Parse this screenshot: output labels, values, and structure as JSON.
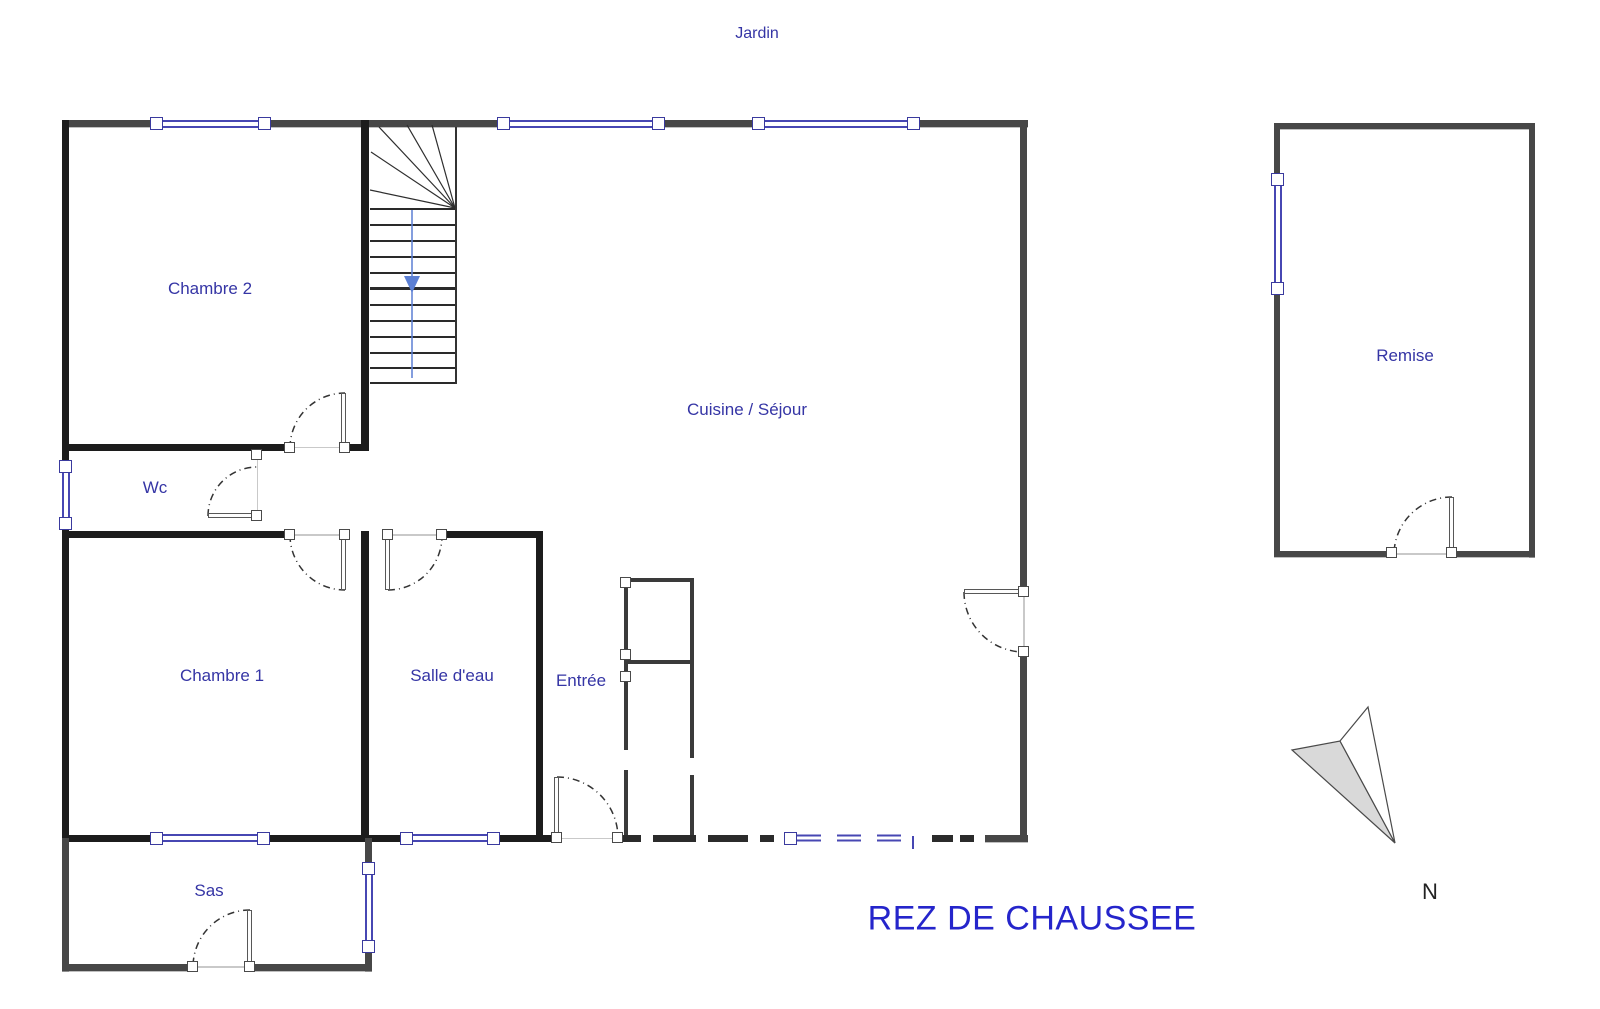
{
  "plan": {
    "title": "REZ DE CHAUSSEE",
    "garden_label": "Jardin",
    "north_label": "N",
    "rooms": [
      {
        "id": "chambre2",
        "label": "Chambre 2"
      },
      {
        "id": "wc",
        "label": "Wc"
      },
      {
        "id": "chambre1",
        "label": "Chambre 1"
      },
      {
        "id": "salle-deau",
        "label": "Salle d'eau"
      },
      {
        "id": "entree",
        "label": "Entrée"
      },
      {
        "id": "cuisine-sejour",
        "label": "Cuisine / Séjour"
      },
      {
        "id": "sas",
        "label": "Sas"
      },
      {
        "id": "remise",
        "label": "Remise"
      }
    ]
  },
  "colors": {
    "label_blue": "#3535a5",
    "title_blue": "#2525cb",
    "window_blue": "#4747b3",
    "wall_black": "#1c1c1c",
    "wall_gray": "#474747",
    "stair_arrow_blue": "#5b7fd4",
    "north_arrow_gray": "#d9d9d9"
  }
}
